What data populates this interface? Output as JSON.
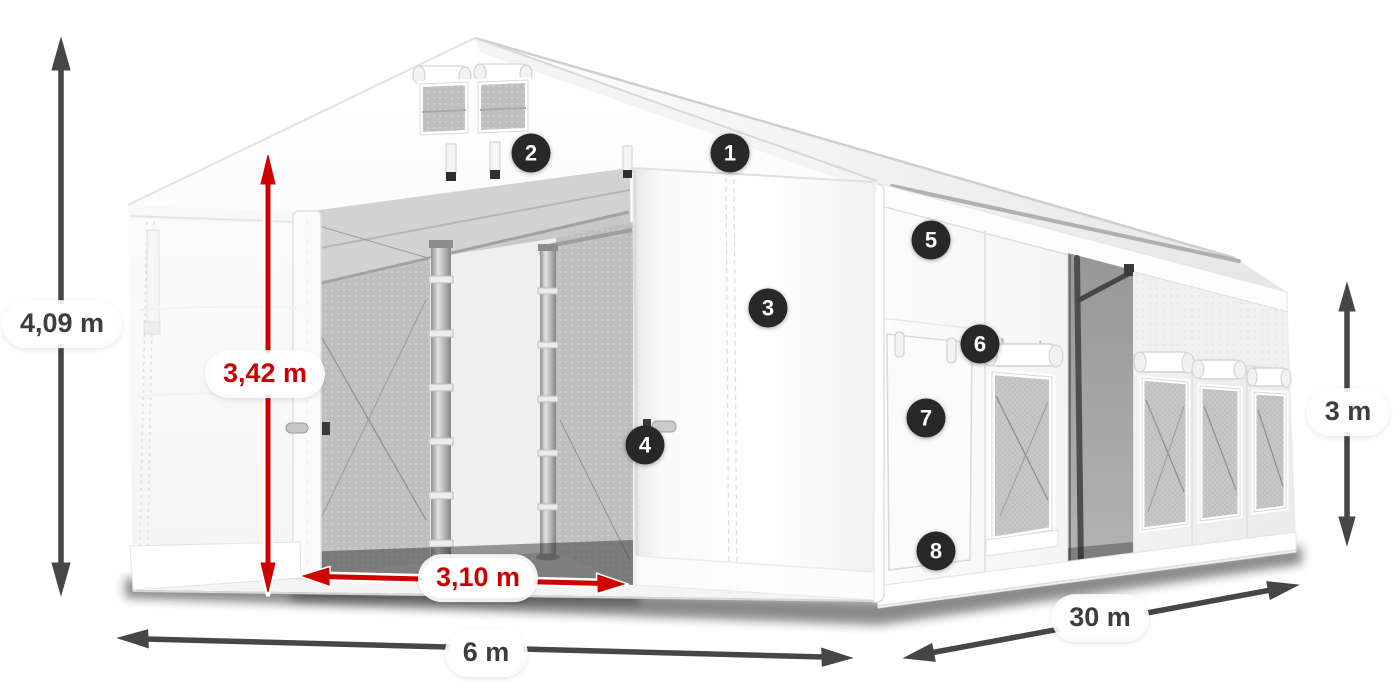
{
  "diagram": {
    "dimensions": {
      "total_height": {
        "value": "4,09 m",
        "style": "dark",
        "orientation": "vertical-left"
      },
      "inner_height": {
        "value": "3,42 m",
        "style": "red",
        "orientation": "vertical-door"
      },
      "door_width": {
        "value": "3,10 m",
        "style": "red",
        "orientation": "horizontal-door"
      },
      "front_width": {
        "value": "6 m",
        "style": "dark",
        "orientation": "horizontal-front"
      },
      "side_length": {
        "value": "30 m",
        "style": "dark",
        "orientation": "diagonal-side"
      },
      "side_height": {
        "value": "3 m",
        "style": "dark",
        "orientation": "vertical-right"
      }
    },
    "callouts": [
      {
        "number": "1"
      },
      {
        "number": "2"
      },
      {
        "number": "3"
      },
      {
        "number": "4"
      },
      {
        "number": "5"
      },
      {
        "number": "6"
      },
      {
        "number": "7"
      },
      {
        "number": "8"
      }
    ],
    "colors": {
      "dimension_dark": "#464646",
      "dimension_red": "#cf0000",
      "badge_background": "#282828",
      "badge_text": "#ffffff",
      "tent_white": "#ffffff",
      "interior_gray": "#c4c4c4"
    }
  }
}
